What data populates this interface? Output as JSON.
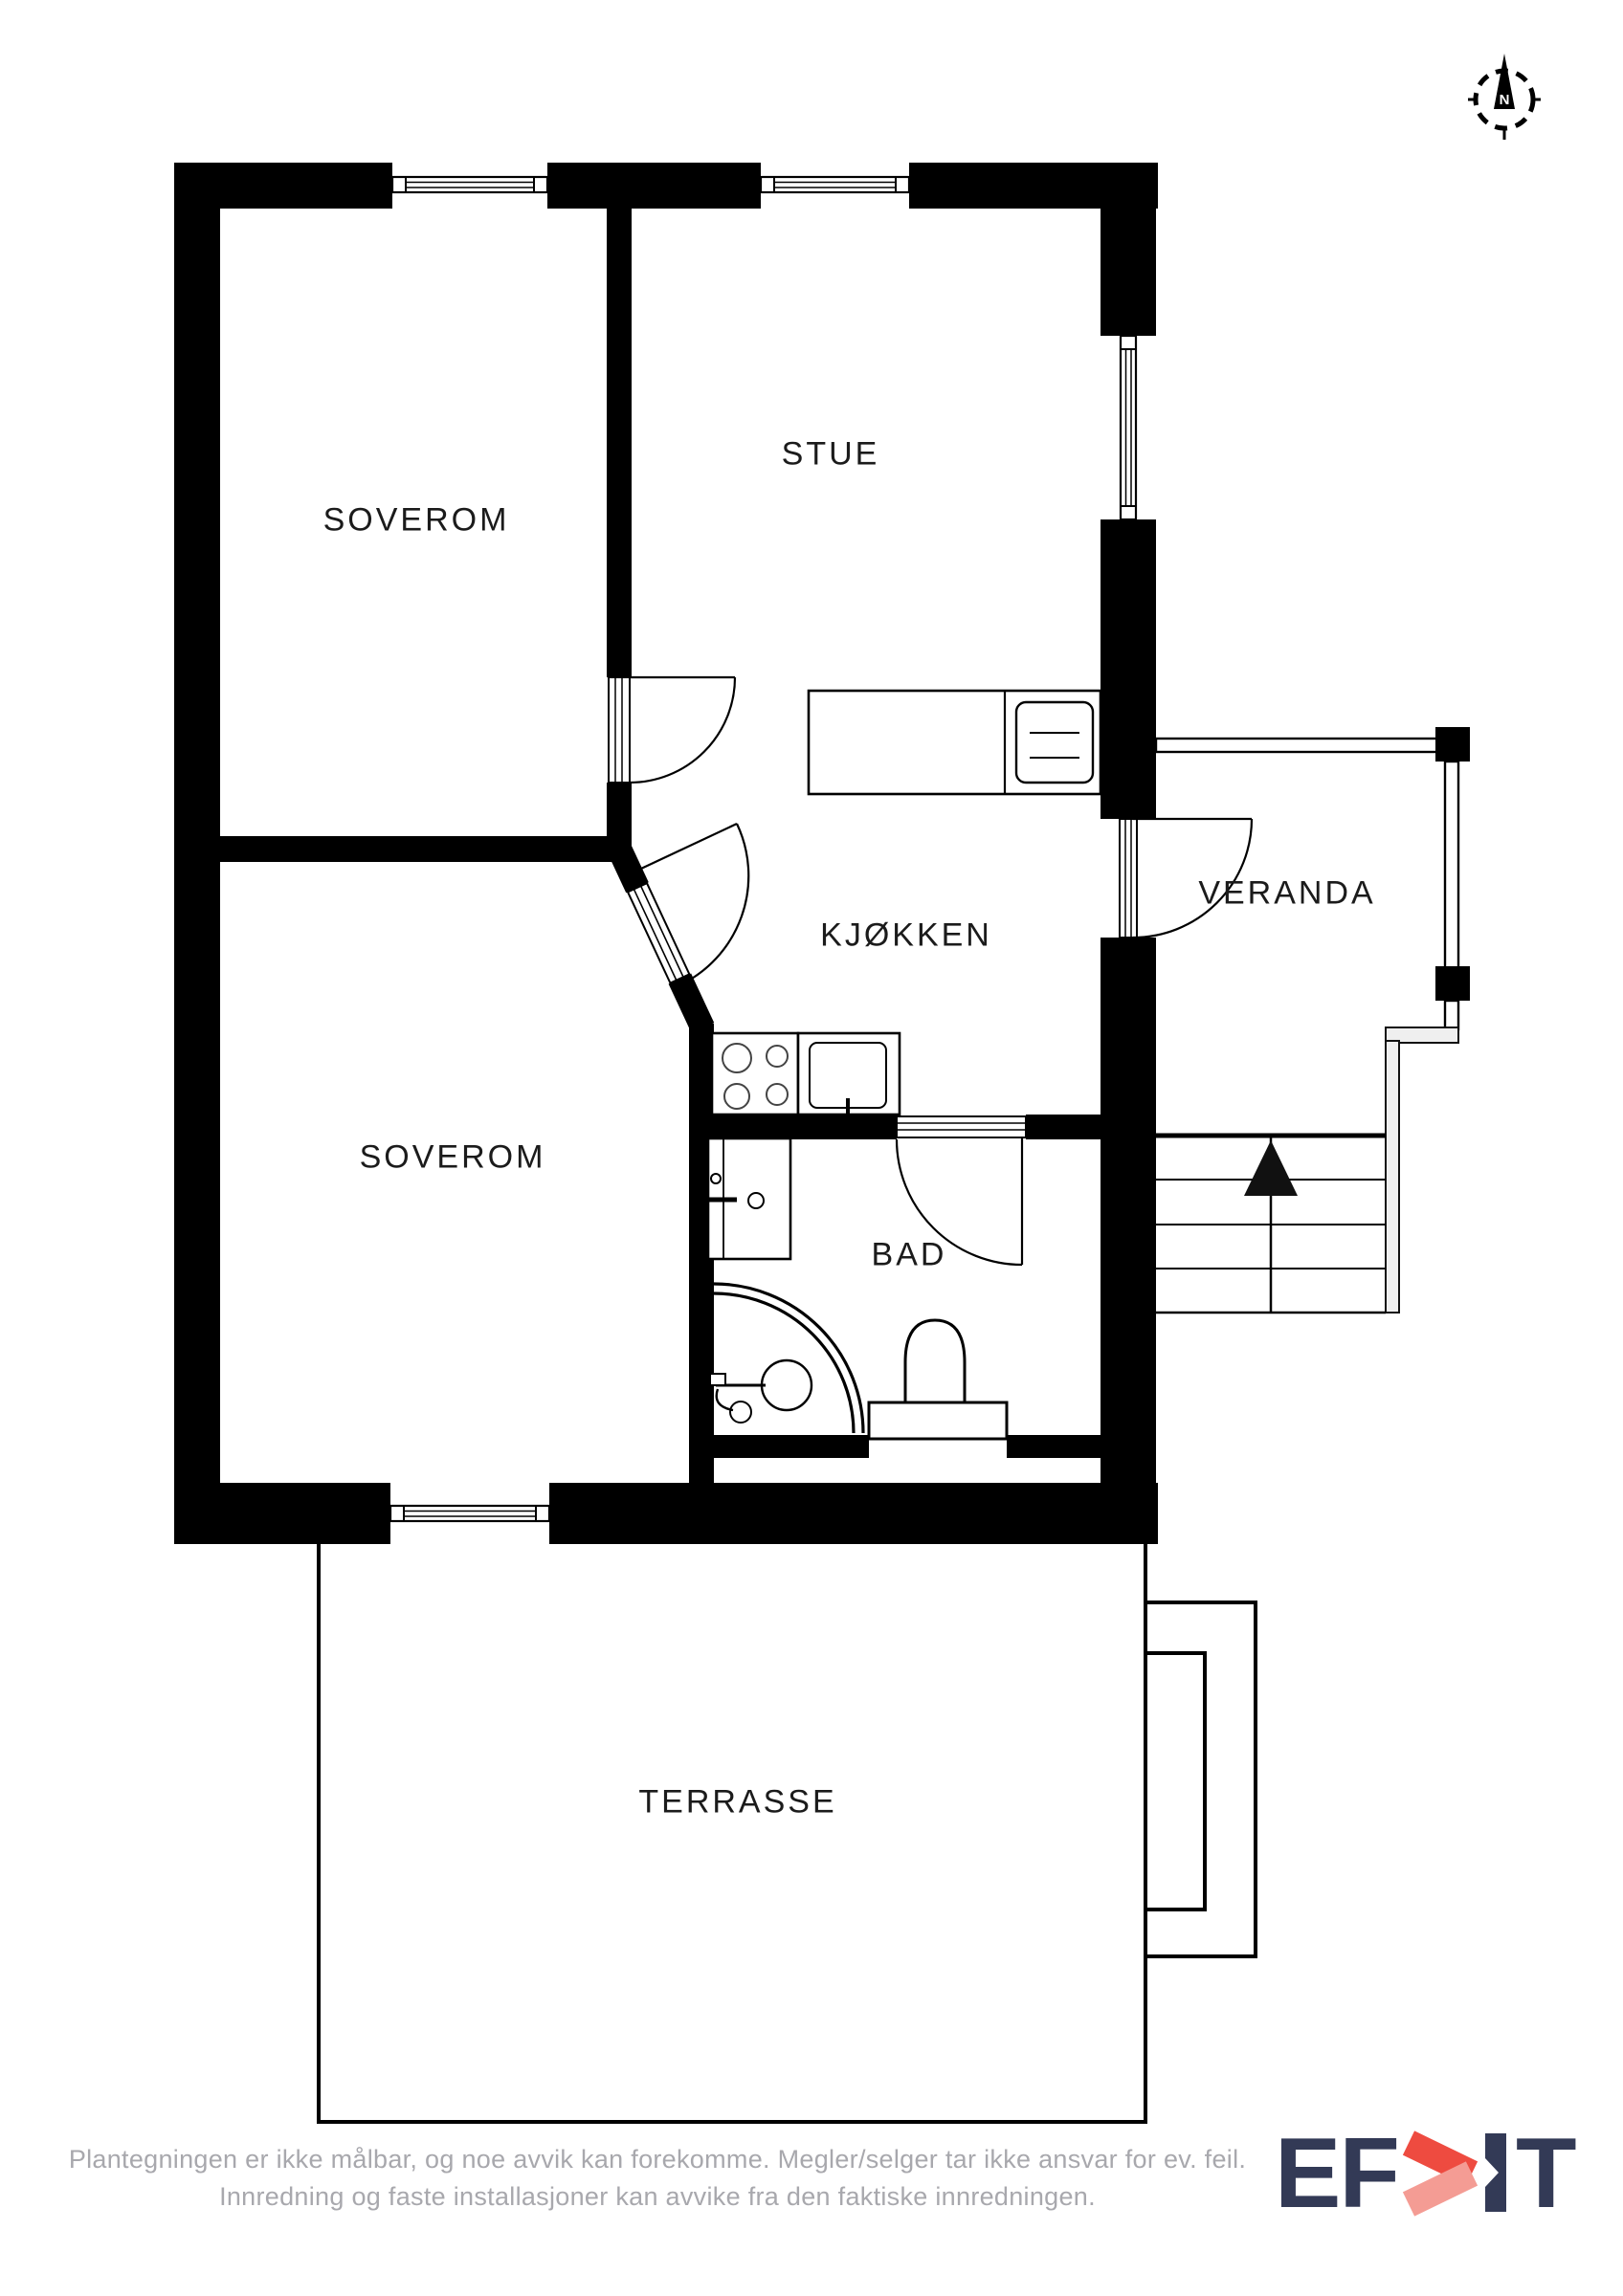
{
  "plan": {
    "rooms": {
      "soverom_top": {
        "label": "SOVEROM"
      },
      "stue": {
        "label": "STUE"
      },
      "kjokken": {
        "label": "KJØKKEN"
      },
      "veranda": {
        "label": "VERANDA"
      },
      "soverom_bottom": {
        "label": "SOVEROM"
      },
      "bad": {
        "label": "BAD"
      },
      "terrasse": {
        "label": "TERRASSE"
      }
    },
    "wall_color": "#000000",
    "label_color": "#1b1b1b"
  },
  "compass": {
    "north_label": "N"
  },
  "footer": {
    "line1": "Plantegningen er ikke målbar, og noe avvik kan forekomme. Megler/selger tar ikke ansvar for ev. feil.",
    "line2": "Innredning og faste installasjoner kan avvike fra den faktiske innredningen.",
    "text_color": "#a8a8ad"
  },
  "logo": {
    "ef": "EF",
    "t": "T",
    "navy": "#333a56",
    "red": "#ee4b40",
    "red_light": "#f49c94"
  }
}
